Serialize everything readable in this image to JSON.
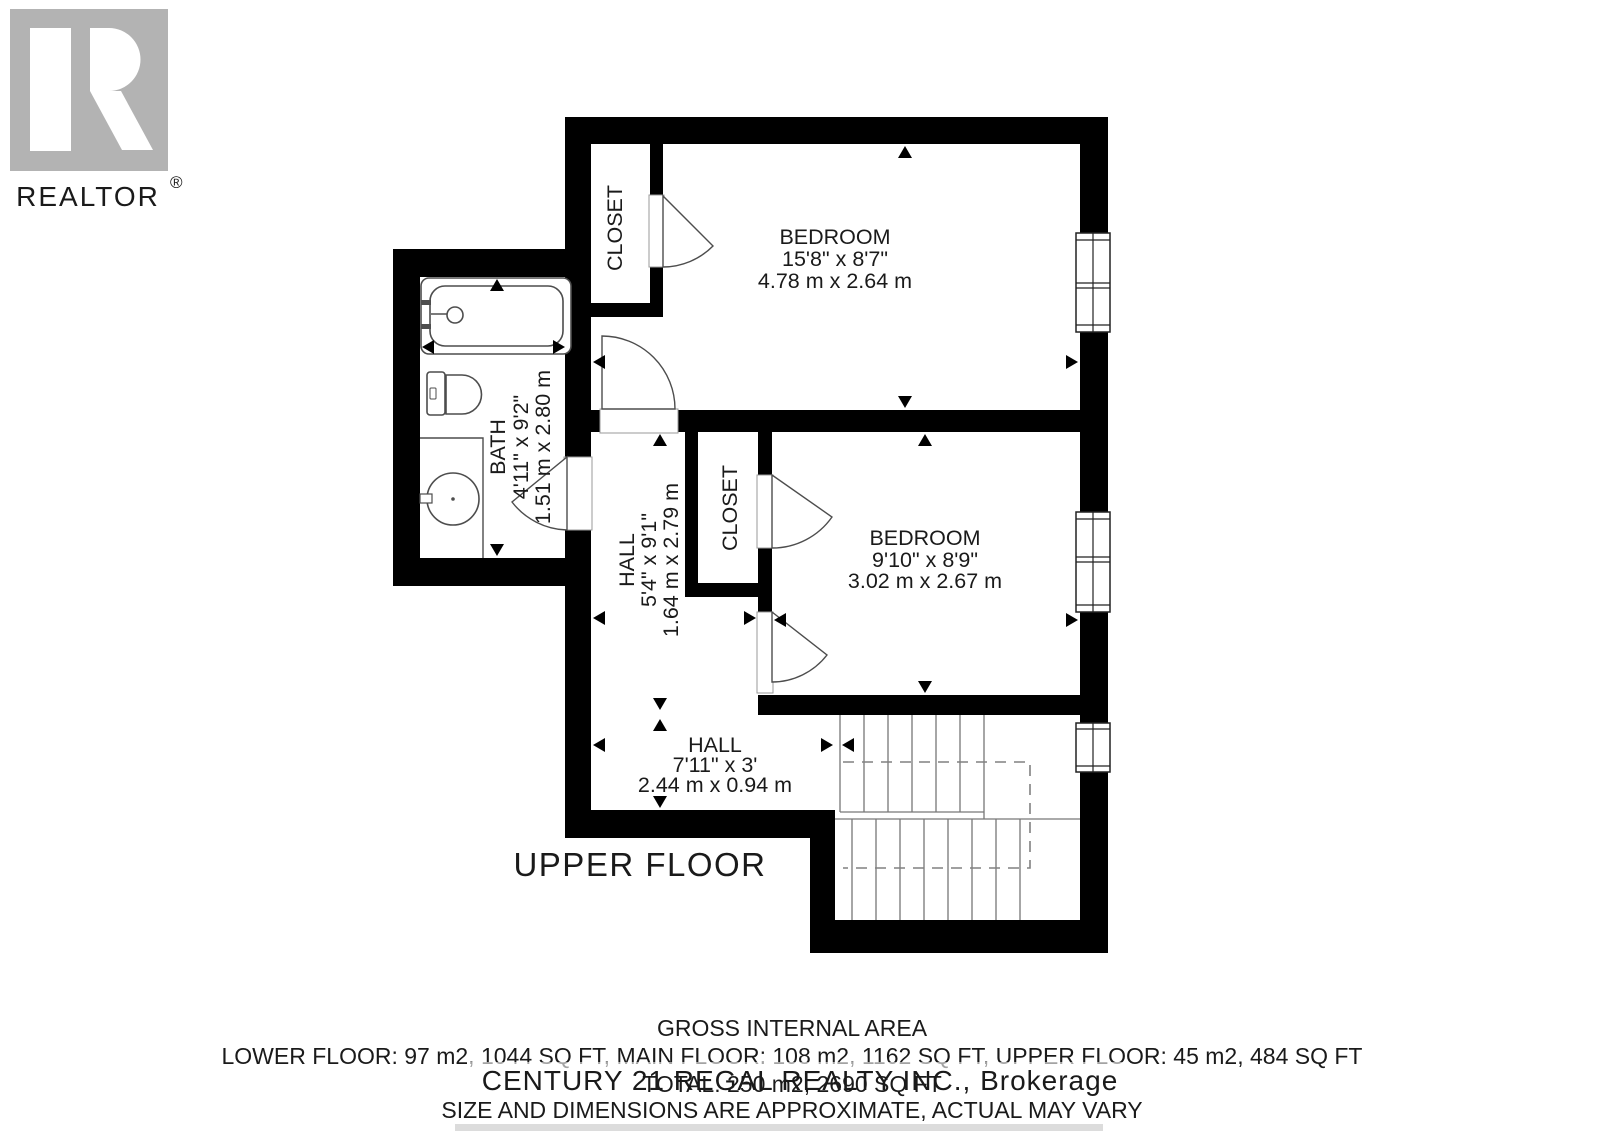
{
  "branding": {
    "logo_text": "REALTOR",
    "logo_reg": "®",
    "logo_color": "#b3b3b3"
  },
  "plan": {
    "floor_label": "UPPER FLOOR",
    "rooms": {
      "bedroom1": {
        "name": "BEDROOM",
        "imperial": "15'8\" x 8'7\"",
        "metric": "4.78 m x 2.64 m"
      },
      "bedroom2": {
        "name": "BEDROOM",
        "imperial": "9'10\" x 8'9\"",
        "metric": "3.02 m x 2.67 m"
      },
      "bath": {
        "name": "BATH",
        "imperial": "4'11\" x 9'2\"",
        "metric": "1.51 m x 2.80 m"
      },
      "hall_upper": {
        "name": "HALL",
        "imperial": "5'4\" x 9'1\"",
        "metric": "1.64 m x 2.79 m"
      },
      "hall_lower": {
        "name": "HALL",
        "imperial": "7'11\" x 3'",
        "metric": "2.44 m x 0.94 m"
      },
      "closet1": {
        "name": "CLOSET"
      },
      "closet2": {
        "name": "CLOSET"
      }
    },
    "icons": [
      "bathtub",
      "toilet",
      "sink",
      "door-arc",
      "window",
      "stairs",
      "dimension-arrow"
    ]
  },
  "footer": {
    "title": "GROSS INTERNAL AREA",
    "area_line": "LOWER FLOOR: 97 m2, 1044 SQ FT, MAIN FLOOR: 108 m2, 1162 SQ FT, UPPER FLOOR: 45 m2, 484 SQ FT",
    "total_line": "TOTAL: 250 m2, 2690 SQ FT",
    "disclaimer": "SIZE AND DIMENSIONS ARE APPROXIMATE, ACTUAL MAY VARY"
  },
  "watermark": {
    "text": "CENTURY 21 REGAL REALTY INC., Brokerage",
    "color": "#c7c7c7"
  },
  "colors": {
    "wall": "#000000",
    "fixture_line": "#4d4d4d",
    "disclaimer_text": "#4d4d4d",
    "text": "#1a1a1a"
  }
}
